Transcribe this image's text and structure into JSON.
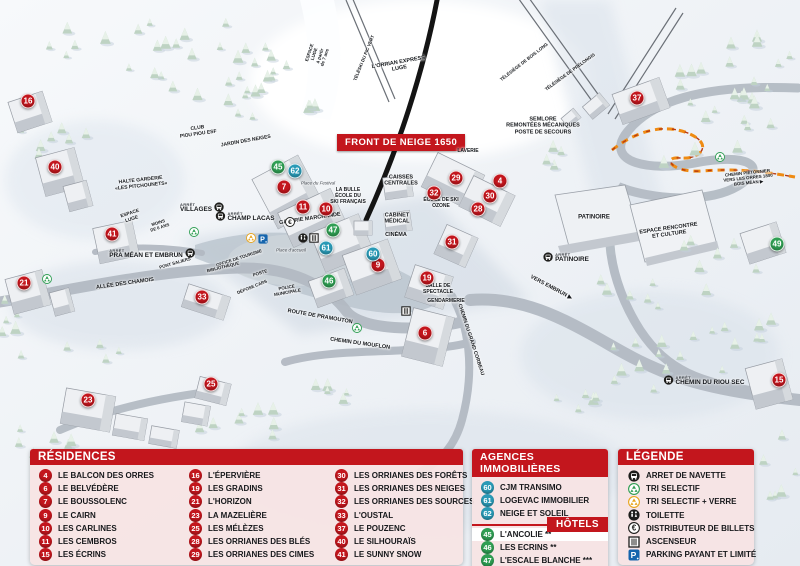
{
  "colors": {
    "red": "#c3161d",
    "blue": "#2a9ab6",
    "green": "#2f9e53",
    "yellow": "#e8a51d",
    "parking": "#1565ad"
  },
  "map": {
    "banner": "FRONT DE NEIGE 1650",
    "markers": [
      {
        "n": "4",
        "color": "red",
        "x": 500,
        "y": 181
      },
      {
        "n": "6",
        "color": "red",
        "x": 425,
        "y": 333
      },
      {
        "n": "7",
        "color": "red",
        "x": 284,
        "y": 187
      },
      {
        "n": "9",
        "color": "red",
        "x": 378,
        "y": 265
      },
      {
        "n": "10",
        "color": "red",
        "x": 326,
        "y": 209
      },
      {
        "n": "11",
        "color": "red",
        "x": 303,
        "y": 207
      },
      {
        "n": "15",
        "color": "red",
        "x": 779,
        "y": 380
      },
      {
        "n": "16",
        "color": "red",
        "x": 28,
        "y": 101
      },
      {
        "n": "19",
        "color": "red",
        "x": 427,
        "y": 278
      },
      {
        "n": "21",
        "color": "red",
        "x": 24,
        "y": 283
      },
      {
        "n": "23",
        "color": "red",
        "x": 88,
        "y": 400
      },
      {
        "n": "25",
        "color": "red",
        "x": 211,
        "y": 384
      },
      {
        "n": "28",
        "color": "red",
        "x": 478,
        "y": 209
      },
      {
        "n": "29",
        "color": "red",
        "x": 456,
        "y": 178
      },
      {
        "n": "30",
        "color": "red",
        "x": 490,
        "y": 196
      },
      {
        "n": "31",
        "color": "red",
        "x": 452,
        "y": 242
      },
      {
        "n": "32",
        "color": "red",
        "x": 434,
        "y": 193
      },
      {
        "n": "33",
        "color": "red",
        "x": 202,
        "y": 297
      },
      {
        "n": "37",
        "color": "red",
        "x": 637,
        "y": 98
      },
      {
        "n": "40",
        "color": "red",
        "x": 55,
        "y": 167
      },
      {
        "n": "41",
        "color": "red",
        "x": 112,
        "y": 234
      },
      {
        "n": "45",
        "color": "green",
        "x": 278,
        "y": 167
      },
      {
        "n": "46",
        "color": "green",
        "x": 329,
        "y": 281
      },
      {
        "n": "47",
        "color": "green",
        "x": 333,
        "y": 230
      },
      {
        "n": "49",
        "color": "green",
        "x": 777,
        "y": 244
      },
      {
        "n": "60",
        "color": "blue",
        "x": 373,
        "y": 254
      },
      {
        "n": "61",
        "color": "blue",
        "x": 326,
        "y": 248
      },
      {
        "n": "62",
        "color": "blue",
        "x": 295,
        "y": 171
      }
    ],
    "labels": [
      {
        "text": "ESPACE\nLUGE\nà partir\nde 7 ans",
        "x": 317,
        "y": 55,
        "rot": -72,
        "size": 4.5
      },
      {
        "text": "TÉLÉSKI DU PIC VERT",
        "x": 364,
        "y": 58,
        "rot": -68,
        "size": 4.5
      },
      {
        "text": "L'ORRIAN EXPRESS\nLUGE",
        "x": 399,
        "y": 66,
        "rot": -10,
        "size": 5.5
      },
      {
        "text": "TÉLÉSIÈGE DE BOIS LONG",
        "x": 524,
        "y": 62,
        "rot": -38,
        "size": 4.5
      },
      {
        "text": "TÉLÉSIÈGE DE PRÉLONGIS",
        "x": 570,
        "y": 72,
        "rot": -36,
        "size": 4.5
      },
      {
        "text": "SEMLORE\nREMONTÉES MÉCANIQUES\nPOSTE DE SECOURS",
        "x": 543,
        "y": 126,
        "rot": 0,
        "size": 5.5
      },
      {
        "text": "CLUB\nPIOU PIOU ESF",
        "x": 198,
        "y": 132,
        "rot": -8,
        "size": 5
      },
      {
        "text": "JARDIN DES NEIGES",
        "x": 246,
        "y": 142,
        "rot": -10,
        "size": 5
      },
      {
        "text": "HALTE GARDERIE\n«LES PITCHOUNETS»",
        "x": 141,
        "y": 184,
        "rot": -6,
        "size": 5
      },
      {
        "text": "ESPACE\nLUGE",
        "x": 131,
        "y": 217,
        "rot": -18,
        "size": 4.8
      },
      {
        "text": "MOINS\nDE 6 ANS",
        "x": 159,
        "y": 225,
        "rot": -18,
        "size": 4.3
      },
      {
        "text": "LAVERIE",
        "x": 468,
        "y": 152,
        "rot": 0,
        "size": 5
      },
      {
        "text": "CAISSES\nCENTRALES",
        "x": 401,
        "y": 181,
        "rot": 0,
        "size": 5.5
      },
      {
        "text": "LA BULLE\nÉCOLE DU\nSKI FRANÇAIS",
        "x": 348,
        "y": 197,
        "rot": 0,
        "size": 5
      },
      {
        "text": "Place du Festival",
        "x": 318,
        "y": 183,
        "rot": 0,
        "size": 4.5,
        "italic": true
      },
      {
        "text": "GALERIE MARCHANDE",
        "x": 310,
        "y": 219,
        "rot": -8,
        "size": 5.5
      },
      {
        "text": "ÉCOLE DE SKI\nOZONE",
        "x": 441,
        "y": 204,
        "rot": 0,
        "size": 5
      },
      {
        "text": "CABINET\nMÉDICAL",
        "x": 397,
        "y": 219,
        "rot": 0,
        "size": 5.5
      },
      {
        "text": "CINÉMA",
        "x": 396,
        "y": 235,
        "rot": 0,
        "size": 5.5
      },
      {
        "text": "OFFICE DE TOURISME",
        "x": 239,
        "y": 258,
        "rot": -18,
        "size": 4.4
      },
      {
        "text": "BIBLIOTHÈQUE",
        "x": 223,
        "y": 267,
        "rot": -14,
        "size": 4.4
      },
      {
        "text": "POSTE",
        "x": 260,
        "y": 273,
        "rot": -18,
        "size": 4.4
      },
      {
        "text": "DÉPOSE CARS",
        "x": 252,
        "y": 287,
        "rot": -22,
        "size": 4.4
      },
      {
        "text": "POLICE\nMUNICIPALE",
        "x": 287,
        "y": 290,
        "rot": -10,
        "size": 4.4
      },
      {
        "text": "Place d'accueil",
        "x": 291,
        "y": 250,
        "rot": 0,
        "size": 4.5,
        "italic": true
      },
      {
        "text": "ALLÉE DES CHAMOIS",
        "x": 125,
        "y": 284,
        "rot": -8,
        "size": 5.5
      },
      {
        "text": "PONT SALIERS",
        "x": 175,
        "y": 263,
        "rot": -16,
        "size": 4.4
      },
      {
        "text": "ROUTE DE PRAMOUTON",
        "x": 320,
        "y": 317,
        "rot": 10,
        "size": 5.5
      },
      {
        "text": "CHEMIN DU MOUFLON",
        "x": 360,
        "y": 344,
        "rot": 8,
        "size": 5.5
      },
      {
        "text": "CHEMIN DU GRAND CORBEAU",
        "x": 470,
        "y": 340,
        "rot": 72,
        "size": 5
      },
      {
        "text": "SALLE DE\nSPECTACLE",
        "x": 438,
        "y": 290,
        "rot": 0,
        "size": 5
      },
      {
        "text": "GENDARMERIE",
        "x": 446,
        "y": 302,
        "rot": 0,
        "size": 5
      },
      {
        "text": "PATINOIRE",
        "x": 594,
        "y": 218,
        "rot": 0,
        "size": 6
      },
      {
        "text": "ESPACE RENCONTRE\nET CULTURE",
        "x": 669,
        "y": 232,
        "rot": -8,
        "size": 5.5
      },
      {
        "text": "VERS EMBRUN ▶",
        "x": 551,
        "y": 288,
        "rot": 28,
        "size": 5.5
      },
      {
        "text": "CHEMIN PIÉTONNIER\nVERS LES ORRES 1800\nBOIS MÉAN ▶",
        "x": 748,
        "y": 178,
        "rot": -6,
        "size": 4.4
      }
    ],
    "bus_stops": [
      {
        "label": "VILLAGES",
        "x": 202,
        "y": 208,
        "iconSide": "right"
      },
      {
        "label": "CHAMP LACAS",
        "x": 245,
        "y": 217,
        "iconSide": "left"
      },
      {
        "label": "PRA MÉAN ET EMBRUN",
        "x": 152,
        "y": 254,
        "iconSide": "right"
      },
      {
        "label": "PATINOIRE",
        "x": 566,
        "y": 258,
        "iconSide": "left"
      },
      {
        "label": "CHEMIN DU RIOU SEC",
        "x": 704,
        "y": 381,
        "iconSide": "left"
      }
    ],
    "icons": [
      {
        "type": "recycle-green",
        "x": 194,
        "y": 232
      },
      {
        "type": "recycle-green",
        "x": 47,
        "y": 279
      },
      {
        "type": "recycle-green",
        "x": 357,
        "y": 328
      },
      {
        "type": "recycle-green",
        "x": 720,
        "y": 157
      },
      {
        "type": "recycle-yellow",
        "x": 251,
        "y": 238
      },
      {
        "type": "parking",
        "x": 263,
        "y": 239
      },
      {
        "type": "euro",
        "x": 290,
        "y": 222
      },
      {
        "type": "wc",
        "x": 303,
        "y": 238
      },
      {
        "type": "elevator",
        "x": 314,
        "y": 238
      },
      {
        "type": "elevator",
        "x": 406,
        "y": 311
      }
    ]
  },
  "panels": {
    "residences": {
      "title": "RÉSIDENCES",
      "columns": [
        [
          {
            "n": "4",
            "label": "LE BALCON DES ORRES"
          },
          {
            "n": "6",
            "label": "LE BELVÉDÈRE"
          },
          {
            "n": "7",
            "label": "LE BOUSSOLENC"
          },
          {
            "n": "9",
            "label": "LE CAIRN"
          },
          {
            "n": "10",
            "label": "LES CARLINES"
          },
          {
            "n": "11",
            "label": "LES CEMBROS"
          },
          {
            "n": "15",
            "label": "LES ÉCRINS"
          }
        ],
        [
          {
            "n": "16",
            "label": "L'ÉPERVIÈRE"
          },
          {
            "n": "19",
            "label": "LES GRADINS"
          },
          {
            "n": "21",
            "label": "L'HORIZON"
          },
          {
            "n": "23",
            "label": "LA MAZELIÈRE"
          },
          {
            "n": "25",
            "label": "LES MÉLÈZES"
          },
          {
            "n": "28",
            "label": "LES ORRIANES DES BLÉS"
          },
          {
            "n": "29",
            "label": "LES ORRIANES DES CIMES"
          }
        ],
        [
          {
            "n": "30",
            "label": "LES ORRIANES DES FORÊTS"
          },
          {
            "n": "31",
            "label": "LES ORRIANES DES NEIGES"
          },
          {
            "n": "32",
            "label": "LES ORRIANES DES SOURCES"
          },
          {
            "n": "33",
            "label": "L'OUSTAL"
          },
          {
            "n": "37",
            "label": "LE POUZENC"
          },
          {
            "n": "40",
            "label": "LE SILHOURAÏS"
          },
          {
            "n": "41",
            "label": "LE SUNNY SNOW"
          }
        ]
      ]
    },
    "agences": {
      "title": "AGENCES IMMOBILIÈRES",
      "items": [
        {
          "n": "60",
          "label": "CJM TRANSIMO"
        },
        {
          "n": "61",
          "label": "LOGEVAC IMMOBILIER"
        },
        {
          "n": "62",
          "label": "NEIGE ET SOLEIL"
        }
      ]
    },
    "hotels": {
      "title": "HÔTELS",
      "items": [
        {
          "n": "45",
          "label": "L'ANCOLIE **"
        },
        {
          "n": "46",
          "label": "LES ECRINS **"
        },
        {
          "n": "47",
          "label": "L'ESCALE BLANCHE ***"
        },
        {
          "n": "49",
          "label": "LES TRAPPEURS **"
        }
      ]
    },
    "legende": {
      "title": "LÉGENDE",
      "items": [
        {
          "icon": "bus",
          "label": "ARRET DE NAVETTE"
        },
        {
          "icon": "recycle-green",
          "label": "TRI SELECTIF"
        },
        {
          "icon": "recycle-yellow",
          "label": "TRI SELECTIF + VERRE"
        },
        {
          "icon": "wc",
          "label": "TOILETTE"
        },
        {
          "icon": "euro",
          "label": "DISTRIBUTEUR DE BILLETS"
        },
        {
          "icon": "elevator",
          "label": "ASCENSEUR"
        },
        {
          "icon": "parking",
          "label": "PARKING PAYANT ET LIMITÉ"
        }
      ]
    }
  }
}
